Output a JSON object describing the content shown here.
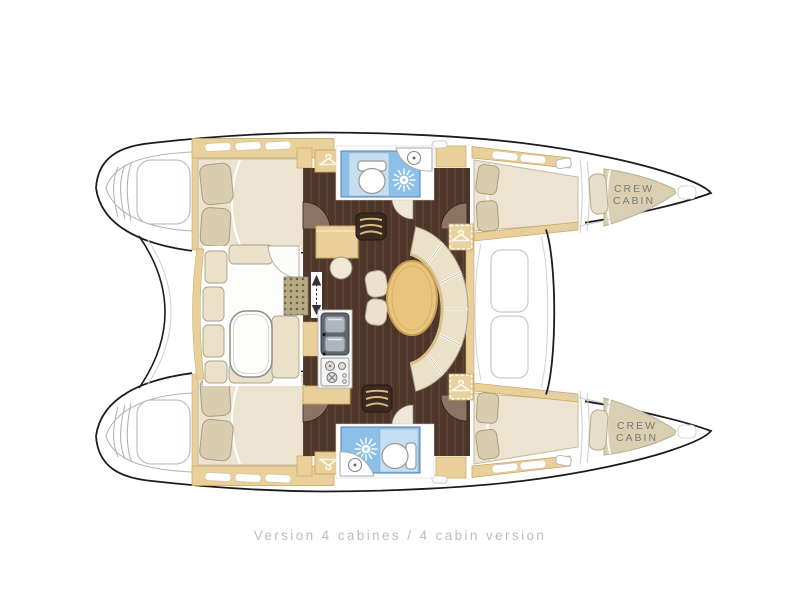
{
  "diagram": {
    "caption": "Version 4 cabines / 4 cabin version",
    "crew_cabin_label": {
      "line1": "CREW",
      "line2": "CABIN"
    }
  },
  "palette": {
    "hull_outline": "#1c1c1c",
    "wood_light": "#e9cf9a",
    "wood_trim": "#c8a761",
    "floor_dark": "#4f372a",
    "cushion_cream": "#ebe1c9",
    "pillow_beige": "#d9cdb0",
    "bed_cream": "#ece4d0",
    "table_wood": "#e8c47c",
    "bathroom_blue": "#8cc0e8",
    "bathroom_blue_light": "#c6def2",
    "deck_line_gray": "#c6c6c6",
    "caption_gray": "#bdbdbd",
    "label_gray": "#7b7b75"
  }
}
